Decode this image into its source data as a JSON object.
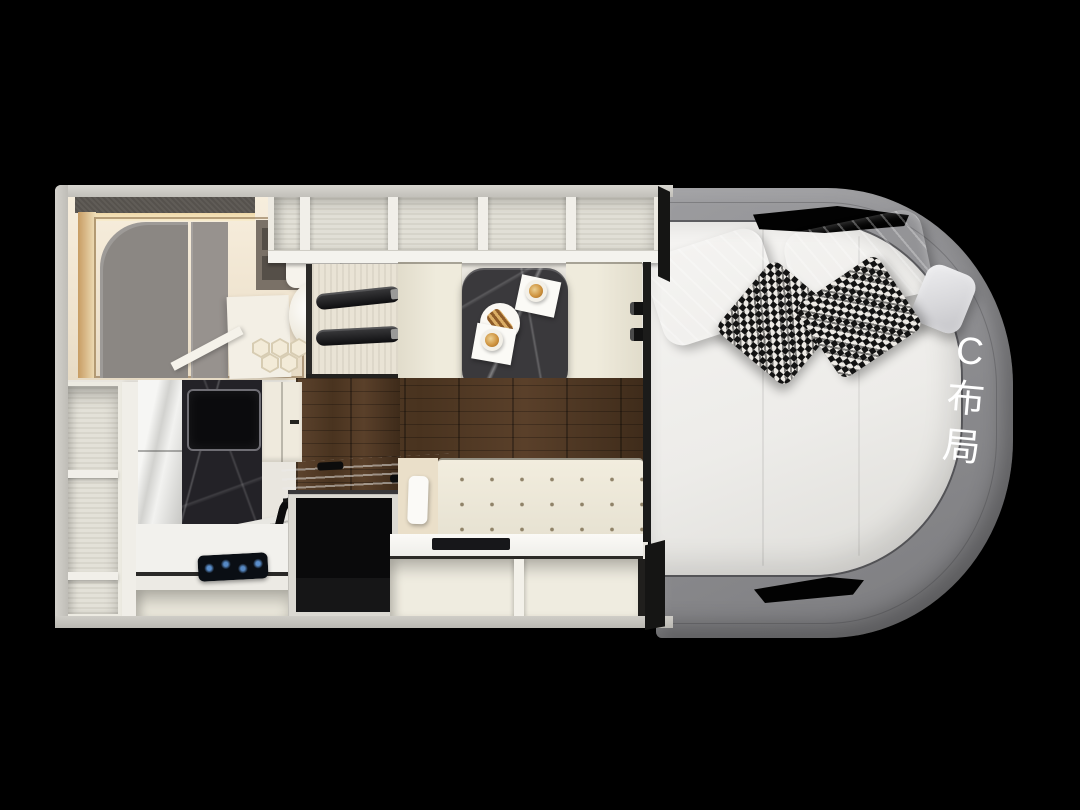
{
  "scene": {
    "type": "rv-motorhome-floorplan-top-view",
    "background": "#000000",
    "label": {
      "full": "C布局",
      "chars": [
        "C",
        "布",
        "局"
      ],
      "color": "#ffffff"
    },
    "palette": {
      "outer_wall": "#ccc9c3",
      "cabinet_cream": "#edeae2",
      "shelf_interior": "#e1dfd6",
      "wood_floor": "#4b3523",
      "table_marble": "#3a393c",
      "kitchen_marble": "#232227",
      "cab_fabric_gray": "#8f8f92",
      "mattress": "#f1f0ed",
      "pillow_gray": "#d5d5d8",
      "sofa_cream": "#ece7d8",
      "appliance_black": "#0c0c0d",
      "warm_glow": "#d8b584"
    },
    "regions": [
      "bathroom",
      "overhead-shelves",
      "wardrobe",
      "dinette",
      "kitchen",
      "left-shelf-column",
      "tv-lift-cabinet",
      "sofa",
      "under-seat-storage",
      "rear-bed",
      "cab-surround"
    ]
  }
}
